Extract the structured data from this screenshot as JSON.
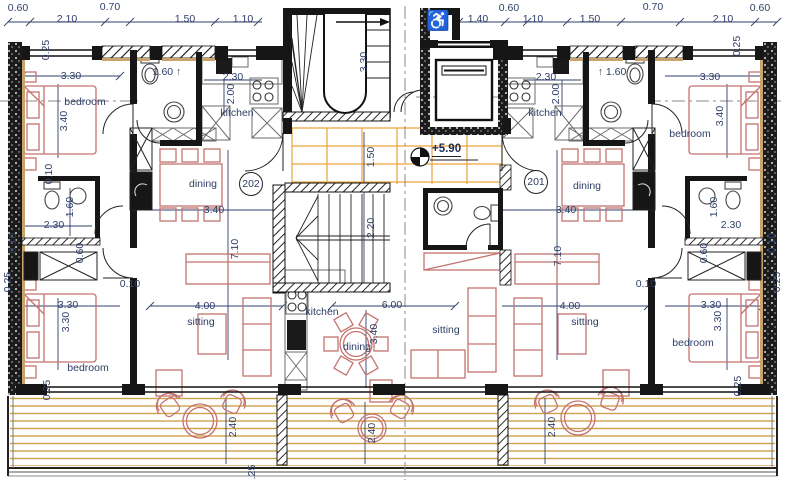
{
  "plan": {
    "level_label": "+5.90",
    "accessibility_symbol": "♿",
    "unit_badges": [
      {
        "label": "202",
        "x": 251,
        "y": 184
      },
      {
        "label": "201",
        "x": 536,
        "y": 182
      }
    ],
    "room_labels": [
      {
        "text": "bedroom",
        "x": 85,
        "y": 102
      },
      {
        "text": "bedroom",
        "x": 690,
        "y": 134
      },
      {
        "text": "bedroom",
        "x": 88,
        "y": 368
      },
      {
        "text": "bedroom",
        "x": 693,
        "y": 343
      },
      {
        "text": "kitchen",
        "x": 237,
        "y": 113
      },
      {
        "text": "kitchen",
        "x": 545,
        "y": 113
      },
      {
        "text": "kitchen",
        "x": 322,
        "y": 312
      },
      {
        "text": "dining",
        "x": 203,
        "y": 184
      },
      {
        "text": "dining",
        "x": 587,
        "y": 186
      },
      {
        "text": "dining",
        "x": 357,
        "y": 347
      },
      {
        "text": "sitting",
        "x": 201,
        "y": 322
      },
      {
        "text": "sitting",
        "x": 446,
        "y": 330
      },
      {
        "text": "sitting",
        "x": 585,
        "y": 322
      }
    ],
    "dim_labels": [
      {
        "text": "0.60",
        "x": 18,
        "y": 8
      },
      {
        "text": "2.10",
        "x": 67,
        "y": 19
      },
      {
        "text": "0.70",
        "x": 110,
        "y": 7
      },
      {
        "text": "1.50",
        "x": 185,
        "y": 19
      },
      {
        "text": "1.10",
        "x": 243,
        "y": 19
      },
      {
        "text": "1.40",
        "x": 478,
        "y": 19
      },
      {
        "text": "0.60",
        "x": 509,
        "y": 8
      },
      {
        "text": "1.10",
        "x": 533,
        "y": 19
      },
      {
        "text": "1.50",
        "x": 590,
        "y": 19
      },
      {
        "text": "0.70",
        "x": 653,
        "y": 7
      },
      {
        "text": "2.10",
        "x": 723,
        "y": 19
      },
      {
        "text": "0.60",
        "x": 760,
        "y": 8
      },
      {
        "text": "0.25",
        "x": 46,
        "y": 50,
        "rot": 1
      },
      {
        "text": "3.30",
        "x": 71,
        "y": 76
      },
      {
        "text": "3.40",
        "x": 64,
        "y": 121,
        "rot": 1
      },
      {
        "text": "0.10",
        "x": 49,
        "y": 174,
        "rot": 1
      },
      {
        "text": "1.60",
        "x": 70,
        "y": 207,
        "rot": 1
      },
      {
        "text": "2.30",
        "x": 54,
        "y": 225
      },
      {
        "text": "0.10",
        "x": 13,
        "y": 243,
        "rot": 1
      },
      {
        "text": "0.60",
        "x": 80,
        "y": 253,
        "rot": 1
      },
      {
        "text": "0.25",
        "x": 8,
        "y": 282,
        "rot": 1
      },
      {
        "text": "3.30",
        "x": 68,
        "y": 305
      },
      {
        "text": "3.30",
        "x": 66,
        "y": 322,
        "rot": 1
      },
      {
        "text": "0.25",
        "x": 47,
        "y": 390,
        "rot": 1
      },
      {
        "text": "0.10",
        "x": 130,
        "y": 284
      },
      {
        "text": "1.60 ↑",
        "x": 167,
        "y": 72
      },
      {
        "text": "2.30",
        "x": 233,
        "y": 77
      },
      {
        "text": "2.00",
        "x": 231,
        "y": 94,
        "rot": 1
      },
      {
        "text": "3.40",
        "x": 214,
        "y": 210
      },
      {
        "text": "7.10",
        "x": 235,
        "y": 249,
        "rot": 1
      },
      {
        "text": "4.00",
        "x": 205,
        "y": 306
      },
      {
        "text": "3.30",
        "x": 364,
        "y": 62,
        "rot": 1
      },
      {
        "text": "1.50",
        "x": 371,
        "y": 157,
        "rot": 1
      },
      {
        "text": "2.20",
        "x": 371,
        "y": 228,
        "rot": 1
      },
      {
        "text": "6.00",
        "x": 392,
        "y": 305
      },
      {
        "text": "3.40",
        "x": 374,
        "y": 334,
        "rot": 1
      },
      {
        "text": "↑ 1.60",
        "x": 612,
        "y": 72
      },
      {
        "text": "2.30",
        "x": 546,
        "y": 77
      },
      {
        "text": "2.00",
        "x": 556,
        "y": 94,
        "rot": 1
      },
      {
        "text": "3.40",
        "x": 566,
        "y": 210
      },
      {
        "text": "7.10",
        "x": 558,
        "y": 256,
        "rot": 1
      },
      {
        "text": "4.00",
        "x": 570,
        "y": 306
      },
      {
        "text": "3.30",
        "x": 710,
        "y": 77
      },
      {
        "text": "3.40",
        "x": 720,
        "y": 116,
        "rot": 1
      },
      {
        "text": "0.25",
        "x": 737,
        "y": 46,
        "rot": 1
      },
      {
        "text": "1.60",
        "x": 714,
        "y": 207,
        "rot": 1
      },
      {
        "text": "2.30",
        "x": 731,
        "y": 225
      },
      {
        "text": "0.10",
        "x": 772,
        "y": 243,
        "rot": 1
      },
      {
        "text": "0.60",
        "x": 704,
        "y": 253,
        "rot": 1
      },
      {
        "text": "0.25",
        "x": 777,
        "y": 282,
        "rot": 1
      },
      {
        "text": "0.10",
        "x": 646,
        "y": 284
      },
      {
        "text": "3.30",
        "x": 711,
        "y": 305
      },
      {
        "text": "3.30",
        "x": 718,
        "y": 321,
        "rot": 1
      },
      {
        "text": "0.25",
        "x": 738,
        "y": 386,
        "rot": 1
      },
      {
        "text": "2.40",
        "x": 233,
        "y": 427,
        "rot": 1
      },
      {
        "text": "2.40",
        "x": 372,
        "y": 433,
        "rot": 1
      },
      {
        "text": "2.40",
        "x": 552,
        "y": 427,
        "rot": 1
      },
      {
        "text": ".25",
        "x": 252,
        "y": 472,
        "rot": 1
      }
    ],
    "colors": {
      "wall": "#161616",
      "dimension_text": "#31406b",
      "furniture_outline": "#c4736e",
      "deck_line": "#cfa14b",
      "tile_line": "#e9a43c",
      "lintel_tan": "#c8a36e"
    }
  }
}
